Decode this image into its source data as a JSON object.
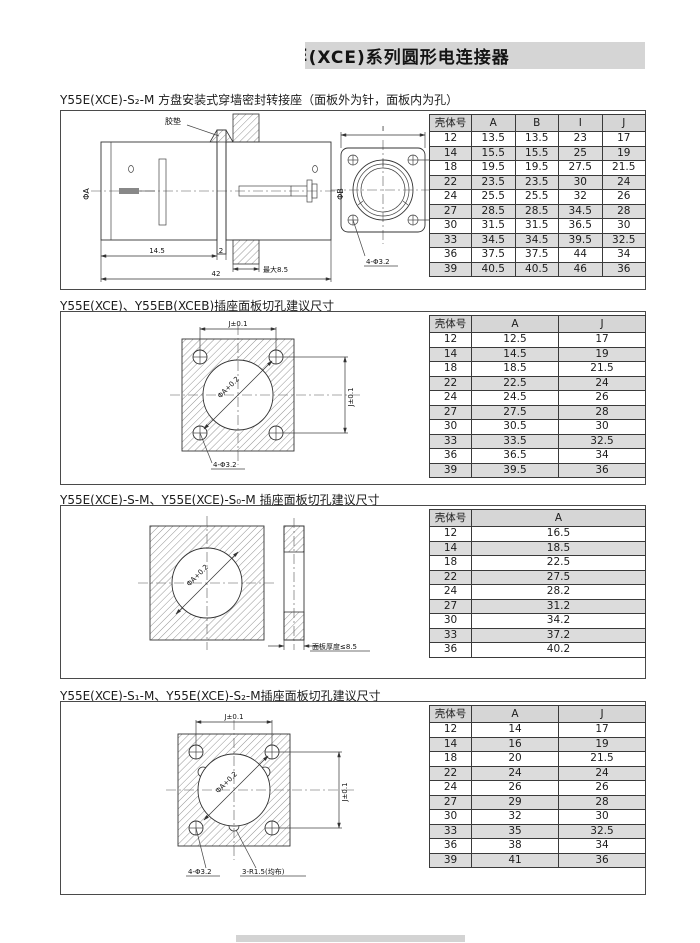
{
  "header": {
    "clipped_prefix": "E",
    "title": "(XCE)系列圆形电连接器"
  },
  "sections": [
    {
      "title": "Y55E(XCE)-S₂-M 方盘安装式穿墙密封转接座（面板外为针，面板内为孔）",
      "drawing": {
        "gasket": "胶垫",
        "phi_a": "ΦA",
        "phi_b": "ΦB",
        "d14": "14.5",
        "d2": "2",
        "dmax": "最大8.5",
        "d42": "42",
        "di": "I",
        "dj": "J",
        "holes": "4-Φ3.2"
      },
      "table": {
        "headers": [
          "壳体号",
          "A",
          "B",
          "I",
          "J"
        ],
        "rows": [
          [
            "12",
            "13.5",
            "13.5",
            "23",
            "17"
          ],
          [
            "14",
            "15.5",
            "15.5",
            "25",
            "19"
          ],
          [
            "18",
            "19.5",
            "19.5",
            "27.5",
            "21.5"
          ],
          [
            "22",
            "23.5",
            "23.5",
            "30",
            "24"
          ],
          [
            "24",
            "25.5",
            "25.5",
            "32",
            "26"
          ],
          [
            "27",
            "28.5",
            "28.5",
            "34.5",
            "28"
          ],
          [
            "30",
            "31.5",
            "31.5",
            "36.5",
            "30"
          ],
          [
            "33",
            "34.5",
            "34.5",
            "39.5",
            "32.5"
          ],
          [
            "36",
            "37.5",
            "37.5",
            "44",
            "34"
          ],
          [
            "39",
            "40.5",
            "40.5",
            "46",
            "36"
          ]
        ]
      }
    },
    {
      "title": "Y55E(XCE)、Y55EB(XCEB)插座面板切孔建议尺寸",
      "drawing": {
        "jtop": "J±0.1",
        "jright": "J±0.1",
        "phia": "ΦA+0.2",
        "holes": "4-Φ3.2"
      },
      "table": {
        "headers": [
          "壳体号",
          "A",
          "J"
        ],
        "rows": [
          [
            "12",
            "12.5",
            "17"
          ],
          [
            "14",
            "14.5",
            "19"
          ],
          [
            "18",
            "18.5",
            "21.5"
          ],
          [
            "22",
            "22.5",
            "24"
          ],
          [
            "24",
            "24.5",
            "26"
          ],
          [
            "27",
            "27.5",
            "28"
          ],
          [
            "30",
            "30.5",
            "30"
          ],
          [
            "33",
            "33.5",
            "32.5"
          ],
          [
            "36",
            "36.5",
            "34"
          ],
          [
            "39",
            "39.5",
            "36"
          ]
        ]
      }
    },
    {
      "title": "Y55E(XCE)-S-M、Y55E(XCE)-S₀-M 插座面板切孔建议尺寸",
      "drawing": {
        "phia": "ΦA+0.2",
        "thick": "面板厚度≤8.5"
      },
      "table": {
        "headers": [
          "壳体号",
          "A"
        ],
        "rows": [
          [
            "12",
            "16.5"
          ],
          [
            "14",
            "18.5"
          ],
          [
            "18",
            "22.5"
          ],
          [
            "22",
            "27.5"
          ],
          [
            "24",
            "28.2"
          ],
          [
            "27",
            "31.2"
          ],
          [
            "30",
            "34.2"
          ],
          [
            "33",
            "37.2"
          ],
          [
            "36",
            "40.2"
          ]
        ]
      }
    },
    {
      "title": "Y55E(XCE)-S₁-M、Y55E(XCE)-S₂-M插座面板切孔建议尺寸",
      "drawing": {
        "jtop": "J±0.1",
        "jright": "J±0.1",
        "phia": "ΦA+0.2",
        "holes": "4-Φ3.2",
        "notch": "3-R1.5(均布)"
      },
      "table": {
        "headers": [
          "壳体号",
          "A",
          "J"
        ],
        "rows": [
          [
            "12",
            "14",
            "17"
          ],
          [
            "14",
            "16",
            "19"
          ],
          [
            "18",
            "20",
            "21.5"
          ],
          [
            "22",
            "24",
            "24"
          ],
          [
            "24",
            "26",
            "26"
          ],
          [
            "27",
            "29",
            "28"
          ],
          [
            "30",
            "32",
            "30"
          ],
          [
            "33",
            "35",
            "32.5"
          ],
          [
            "36",
            "38",
            "34"
          ],
          [
            "39",
            "41",
            "36"
          ]
        ]
      }
    }
  ]
}
